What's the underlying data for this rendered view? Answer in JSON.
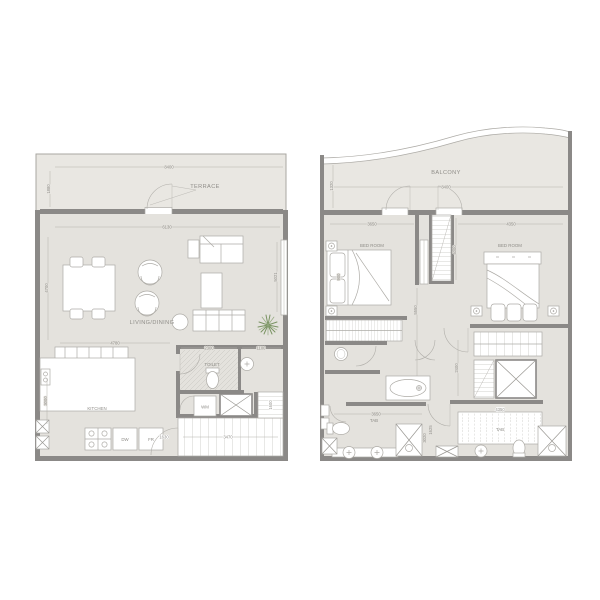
{
  "colors": {
    "wall": "#8b8987",
    "floor": "#e4e2dd",
    "terrace_floor": "#e9e7e2",
    "furniture_line": "#adaba6",
    "dimension_text": "#908e89",
    "plant_green": "#7b9464",
    "background": "#ffffff"
  },
  "lower": {
    "labels": {
      "terrace": "TERRACE",
      "living_dining": "LIVING/DINING",
      "kitchen": "KITCHEN",
      "toilet": "TOILET",
      "washing_machine": "WM",
      "dishwasher": "DW",
      "fridge": "FR"
    },
    "dims": {
      "terrace_width": "8400",
      "terrace_depth": "1880",
      "living_width": "6130",
      "living_depth": "4700",
      "kitchen_width": "4780",
      "toilet_width": "2300",
      "shaft_width": "1100",
      "window_height": "5021",
      "kitchen_depth": "3000",
      "entry_width": "1630",
      "stair_width": "3470",
      "stair_depth": "1600"
    }
  },
  "upper": {
    "labels": {
      "balcony": "BALCONY",
      "bedroom_left": "BED ROOM",
      "bedroom_right": "BED ROOM",
      "bathroom_left": "TAB",
      "bathroom_right": "TAB"
    },
    "dims": {
      "balcony_width": "8400",
      "balcony_depth": "1320",
      "bedroom_left_width": "3650",
      "bedroom_right_width": "4350",
      "stair_depth": "4000",
      "corridor_depth": "5550",
      "hall_depth": "2400",
      "bathroom_width": "3650",
      "shower_depth": "3020",
      "hall_width": "4350",
      "bath_depth": "1625",
      "bed_width": "900"
    }
  }
}
